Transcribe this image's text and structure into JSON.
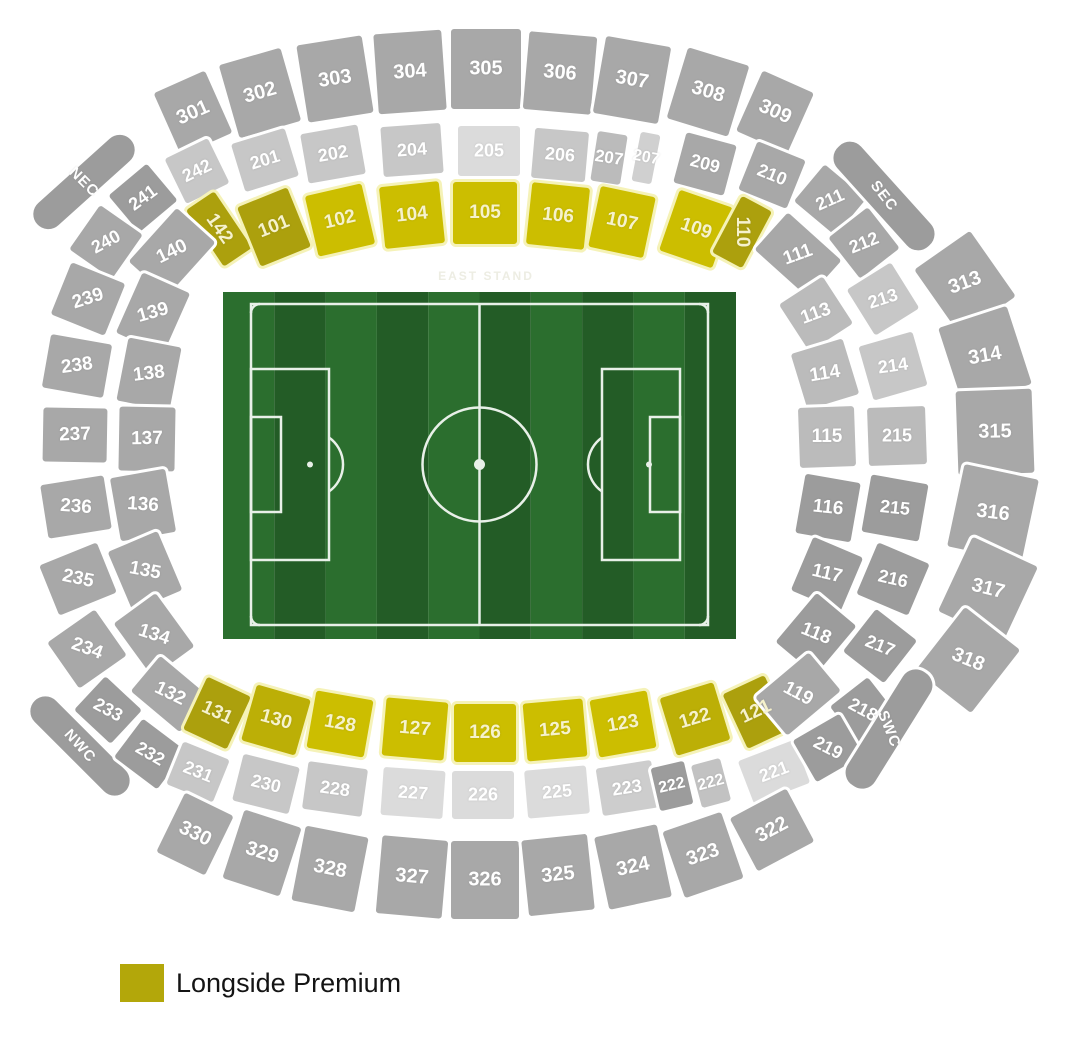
{
  "canvas": {
    "w": 1089,
    "h": 1051,
    "bg": "#FFFFFF"
  },
  "fills": {
    "g": "#A8A8A8",
    "d": "#9C9C9C",
    "l": "#C7C7C7",
    "ll": "#DBDBDB",
    "m": "#BBBBBB",
    "m2": "#D0D0D0",
    "m3": "#CDCDCD",
    "m4": "#C2C2C2",
    "yb": "#CCBE00",
    "ym": "#BCAF06",
    "yd": "#ACA00D"
  },
  "borders": {
    "gray": "#FFFFFF",
    "yellow": "#F5F2B8"
  },
  "text_colors": {
    "gray": "#FFFFFF",
    "yellow": "#F6F2CC"
  },
  "stand_label": {
    "text": "EAST STAND",
    "x": 486,
    "y": 276,
    "color": "#EDEDE3",
    "fs": 12
  },
  "legend": {
    "label": "Longside Premium",
    "swatch": "#B3A70A",
    "x": 120,
    "y": 964
  },
  "pitch": {
    "x": 223,
    "y": 292,
    "w": 513,
    "h": 347,
    "stripe_a": "#2B6E2E",
    "stripe_b": "#235C26",
    "line": "#E8F0E8"
  },
  "sections": [
    {
      "id": "301",
      "label": "301",
      "x": 193,
      "y": 113,
      "w": 62,
      "h": 74,
      "r": -24,
      "f": "g",
      "fs": 20
    },
    {
      "id": "302",
      "label": "302",
      "x": 260,
      "y": 93,
      "w": 70,
      "h": 82,
      "r": -16,
      "f": "g",
      "fs": 20
    },
    {
      "id": "303",
      "label": "303",
      "x": 335,
      "y": 79,
      "w": 72,
      "h": 84,
      "r": -9,
      "f": "g",
      "fs": 20
    },
    {
      "id": "304",
      "label": "304",
      "x": 410,
      "y": 72,
      "w": 74,
      "h": 86,
      "r": -4,
      "f": "g",
      "fs": 20
    },
    {
      "id": "305",
      "label": "305",
      "x": 486,
      "y": 69,
      "w": 76,
      "h": 86,
      "r": 0,
      "f": "g",
      "fs": 20
    },
    {
      "id": "306",
      "label": "306",
      "x": 560,
      "y": 73,
      "w": 74,
      "h": 84,
      "r": 5,
      "f": "g",
      "fs": 20
    },
    {
      "id": "307",
      "label": "307",
      "x": 632,
      "y": 80,
      "w": 72,
      "h": 84,
      "r": 10,
      "f": "g",
      "fs": 20
    },
    {
      "id": "308",
      "label": "308",
      "x": 708,
      "y": 92,
      "w": 70,
      "h": 80,
      "r": 17,
      "f": "g",
      "fs": 20
    },
    {
      "id": "309",
      "label": "309",
      "x": 775,
      "y": 112,
      "w": 62,
      "h": 72,
      "r": 24,
      "f": "g",
      "fs": 20
    },
    {
      "id": "242",
      "label": "242",
      "x": 197,
      "y": 171,
      "w": 54,
      "h": 56,
      "r": -26,
      "f": "l",
      "fs": 18
    },
    {
      "id": "201",
      "label": "201",
      "x": 265,
      "y": 160,
      "w": 62,
      "h": 56,
      "r": -17,
      "f": "l",
      "fs": 18
    },
    {
      "id": "202",
      "label": "202",
      "x": 333,
      "y": 154,
      "w": 64,
      "h": 56,
      "r": -10,
      "f": "l",
      "fs": 18
    },
    {
      "id": "204",
      "label": "204",
      "x": 412,
      "y": 150,
      "w": 66,
      "h": 56,
      "r": -4,
      "f": "l",
      "fs": 18
    },
    {
      "id": "205",
      "label": "205",
      "x": 489,
      "y": 151,
      "w": 68,
      "h": 56,
      "r": 0,
      "f": "ll",
      "fs": 18
    },
    {
      "id": "206",
      "label": "206",
      "x": 560,
      "y": 155,
      "w": 60,
      "h": 56,
      "r": 5,
      "f": "l",
      "fs": 18
    },
    {
      "id": "207-a",
      "label": "207",
      "x": 609,
      "y": 158,
      "w": 36,
      "h": 56,
      "r": 9,
      "f": "m",
      "fs": 17
    },
    {
      "id": "207-b",
      "label": "207",
      "x": 646,
      "y": 158,
      "w": 26,
      "h": 56,
      "r": 11,
      "f": "m2",
      "fs": 16
    },
    {
      "id": "209",
      "label": "209",
      "x": 705,
      "y": 164,
      "w": 58,
      "h": 58,
      "r": 15,
      "f": "g",
      "fs": 18
    },
    {
      "id": "210",
      "label": "210",
      "x": 772,
      "y": 175,
      "w": 58,
      "h": 58,
      "r": 22,
      "f": "g",
      "fs": 18
    },
    {
      "id": "142",
      "label": "142",
      "x": 219,
      "y": 229,
      "w": 40,
      "h": 74,
      "r": -34,
      "tr": 55,
      "f": "yd",
      "fs": 19
    },
    {
      "id": "101",
      "label": "101",
      "x": 274,
      "y": 227,
      "w": 60,
      "h": 70,
      "r": -22,
      "f": "yd",
      "fs": 19
    },
    {
      "id": "102",
      "label": "102",
      "x": 340,
      "y": 220,
      "w": 64,
      "h": 68,
      "r": -13,
      "f": "yb",
      "fs": 19
    },
    {
      "id": "104",
      "label": "104",
      "x": 412,
      "y": 215,
      "w": 66,
      "h": 68,
      "r": -6,
      "f": "yb",
      "fs": 19
    },
    {
      "id": "105",
      "label": "105",
      "x": 485,
      "y": 213,
      "w": 70,
      "h": 68,
      "r": 0,
      "f": "yb",
      "fs": 19
    },
    {
      "id": "106",
      "label": "106",
      "x": 558,
      "y": 216,
      "w": 64,
      "h": 68,
      "r": 6,
      "f": "yb",
      "fs": 19
    },
    {
      "id": "107",
      "label": "107",
      "x": 622,
      "y": 222,
      "w": 62,
      "h": 68,
      "r": 12,
      "f": "yb",
      "fs": 19
    },
    {
      "id": "109",
      "label": "109",
      "x": 696,
      "y": 229,
      "w": 62,
      "h": 70,
      "r": 19,
      "f": "yb",
      "fs": 19
    },
    {
      "id": "110",
      "label": "110",
      "x": 742,
      "y": 232,
      "w": 40,
      "h": 70,
      "r": 28,
      "tr": 90,
      "f": "yd",
      "fs": 19
    },
    {
      "id": "nec",
      "label": "NEC",
      "x": 84,
      "y": 182,
      "w": 132,
      "h": 36,
      "r": -42,
      "tr": 45,
      "f": "d",
      "fs": 15,
      "rad": 18,
      "ls": 1
    },
    {
      "id": "241",
      "label": "241",
      "x": 143,
      "y": 198,
      "w": 56,
      "h": 54,
      "r": -40,
      "tr": -36,
      "f": "d",
      "fs": 18
    },
    {
      "id": "240",
      "label": "240",
      "x": 106,
      "y": 242,
      "w": 60,
      "h": 58,
      "r": -55,
      "tr": -28,
      "f": "g",
      "fs": 18
    },
    {
      "id": "140",
      "label": "140",
      "x": 172,
      "y": 252,
      "w": 78,
      "h": 58,
      "r": -48,
      "tr": -26,
      "f": "g",
      "fs": 19
    },
    {
      "id": "239",
      "label": "239",
      "x": 88,
      "y": 299,
      "w": 62,
      "h": 64,
      "r": -68,
      "tr": -18,
      "f": "g",
      "fs": 19
    },
    {
      "id": "238",
      "label": "238",
      "x": 77,
      "y": 366,
      "w": 60,
      "h": 68,
      "r": -80,
      "tr": -8,
      "f": "g",
      "fs": 19
    },
    {
      "id": "237",
      "label": "237",
      "x": 75,
      "y": 435,
      "w": 60,
      "h": 70,
      "r": -89,
      "tr": -2,
      "f": "g",
      "fs": 19
    },
    {
      "id": "236",
      "label": "236",
      "x": 76,
      "y": 507,
      "w": 60,
      "h": 70,
      "r": 81,
      "tr": 4,
      "f": "g",
      "fs": 19
    },
    {
      "id": "235",
      "label": "235",
      "x": 78,
      "y": 579,
      "w": 60,
      "h": 68,
      "r": 68,
      "tr": 12,
      "f": "g",
      "fs": 19
    },
    {
      "id": "234",
      "label": "234",
      "x": 87,
      "y": 649,
      "w": 62,
      "h": 64,
      "r": 55,
      "tr": 20,
      "f": "g",
      "fs": 19
    },
    {
      "id": "233",
      "label": "233",
      "x": 108,
      "y": 710,
      "w": 56,
      "h": 52,
      "r": 43,
      "tr": 28,
      "f": "d",
      "fs": 18
    },
    {
      "id": "139",
      "label": "139",
      "x": 153,
      "y": 313,
      "w": 72,
      "h": 58,
      "r": -66,
      "tr": -16,
      "f": "g",
      "fs": 19
    },
    {
      "id": "138",
      "label": "138",
      "x": 149,
      "y": 374,
      "w": 70,
      "h": 60,
      "r": -79,
      "tr": -7,
      "f": "g",
      "fs": 19
    },
    {
      "id": "137",
      "label": "137",
      "x": 147,
      "y": 439,
      "w": 70,
      "h": 62,
      "r": -89,
      "tr": -1,
      "f": "g",
      "fs": 19
    },
    {
      "id": "136",
      "label": "136",
      "x": 143,
      "y": 505,
      "w": 70,
      "h": 62,
      "r": 80,
      "tr": 4,
      "f": "g",
      "fs": 19
    },
    {
      "id": "135",
      "label": "135",
      "x": 145,
      "y": 571,
      "w": 70,
      "h": 60,
      "r": 67,
      "tr": 11,
      "f": "g",
      "fs": 19
    },
    {
      "id": "134",
      "label": "134",
      "x": 154,
      "y": 635,
      "w": 72,
      "h": 58,
      "r": 54,
      "tr": 18,
      "f": "g",
      "fs": 19
    },
    {
      "id": "132",
      "label": "132",
      "x": 170,
      "y": 694,
      "w": 70,
      "h": 52,
      "r": 40,
      "tr": 26,
      "f": "g",
      "fs": 19
    },
    {
      "id": "nwc",
      "label": "NWC",
      "x": 80,
      "y": 746,
      "w": 134,
      "h": 36,
      "r": 45,
      "tr": 48,
      "f": "d",
      "fs": 15,
      "rad": 18,
      "ls": 1
    },
    {
      "id": "232",
      "label": "232",
      "x": 150,
      "y": 754,
      "w": 60,
      "h": 54,
      "r": 37,
      "tr": 30,
      "f": "d",
      "fs": 18
    },
    {
      "id": "131",
      "label": "131",
      "x": 217,
      "y": 713,
      "w": 54,
      "h": 64,
      "r": 25,
      "f": "yd",
      "fs": 19
    },
    {
      "id": "130",
      "label": "130",
      "x": 276,
      "y": 720,
      "w": 62,
      "h": 64,
      "r": 16,
      "f": "ym",
      "fs": 19
    },
    {
      "id": "128",
      "label": "128",
      "x": 340,
      "y": 724,
      "w": 64,
      "h": 64,
      "r": 10,
      "f": "yb",
      "fs": 19
    },
    {
      "id": "127",
      "label": "127",
      "x": 415,
      "y": 729,
      "w": 68,
      "h": 64,
      "r": 5,
      "f": "yb",
      "fs": 19
    },
    {
      "id": "126",
      "label": "126",
      "x": 485,
      "y": 733,
      "w": 68,
      "h": 64,
      "r": 0,
      "f": "yb",
      "fs": 19
    },
    {
      "id": "125",
      "label": "125",
      "x": 555,
      "y": 730,
      "w": 66,
      "h": 64,
      "r": -5,
      "f": "yb",
      "fs": 19
    },
    {
      "id": "123",
      "label": "123",
      "x": 623,
      "y": 724,
      "w": 64,
      "h": 64,
      "r": -10,
      "f": "yb",
      "fs": 19
    },
    {
      "id": "122",
      "label": "122",
      "x": 695,
      "y": 719,
      "w": 62,
      "h": 66,
      "r": -17,
      "f": "ym",
      "fs": 19
    },
    {
      "id": "121",
      "label": "121",
      "x": 756,
      "y": 712,
      "w": 52,
      "h": 66,
      "r": -25,
      "f": "yd",
      "fs": 19
    },
    {
      "id": "231",
      "label": "231",
      "x": 198,
      "y": 772,
      "w": 56,
      "h": 52,
      "r": 22,
      "f": "l",
      "fs": 18
    },
    {
      "id": "230",
      "label": "230",
      "x": 266,
      "y": 784,
      "w": 64,
      "h": 54,
      "r": 14,
      "f": "l",
      "fs": 18
    },
    {
      "id": "228",
      "label": "228",
      "x": 335,
      "y": 789,
      "w": 66,
      "h": 54,
      "r": 8,
      "f": "l",
      "fs": 18
    },
    {
      "id": "227",
      "label": "227",
      "x": 413,
      "y": 793,
      "w": 68,
      "h": 54,
      "r": 4,
      "f": "ll",
      "fs": 18
    },
    {
      "id": "226",
      "label": "226",
      "x": 483,
      "y": 795,
      "w": 68,
      "h": 54,
      "r": 0,
      "f": "ll",
      "fs": 18
    },
    {
      "id": "225",
      "label": "225",
      "x": 557,
      "y": 792,
      "w": 68,
      "h": 54,
      "r": -5,
      "f": "ll",
      "fs": 18
    },
    {
      "id": "223",
      "label": "223",
      "x": 627,
      "y": 788,
      "w": 62,
      "h": 54,
      "r": -9,
      "f": "m3",
      "fs": 18
    },
    {
      "id": "222-a",
      "label": "222",
      "x": 672,
      "y": 786,
      "w": 40,
      "h": 50,
      "r": -13,
      "f": "d",
      "fs": 16
    },
    {
      "id": "222-b",
      "label": "222",
      "x": 711,
      "y": 783,
      "w": 36,
      "h": 50,
      "r": -15,
      "f": "m4",
      "fs": 16
    },
    {
      "id": "221",
      "label": "221",
      "x": 774,
      "y": 772,
      "w": 66,
      "h": 52,
      "r": -21,
      "f": "ll",
      "fs": 18
    },
    {
      "id": "330",
      "label": "330",
      "x": 195,
      "y": 834,
      "w": 60,
      "h": 72,
      "r": 26,
      "f": "g",
      "fs": 20
    },
    {
      "id": "329",
      "label": "329",
      "x": 262,
      "y": 853,
      "w": 66,
      "h": 78,
      "r": 18,
      "f": "g",
      "fs": 20
    },
    {
      "id": "328",
      "label": "328",
      "x": 330,
      "y": 869,
      "w": 70,
      "h": 82,
      "r": 11,
      "f": "g",
      "fs": 20
    },
    {
      "id": "327",
      "label": "327",
      "x": 412,
      "y": 877,
      "w": 72,
      "h": 84,
      "r": 5,
      "f": "g",
      "fs": 20
    },
    {
      "id": "326",
      "label": "326",
      "x": 485,
      "y": 880,
      "w": 74,
      "h": 84,
      "r": 0,
      "f": "g",
      "fs": 20
    },
    {
      "id": "325",
      "label": "325",
      "x": 558,
      "y": 875,
      "w": 72,
      "h": 82,
      "r": -6,
      "f": "g",
      "fs": 20
    },
    {
      "id": "324",
      "label": "324",
      "x": 633,
      "y": 867,
      "w": 70,
      "h": 80,
      "r": -12,
      "f": "g",
      "fs": 20
    },
    {
      "id": "323",
      "label": "323",
      "x": 703,
      "y": 855,
      "w": 68,
      "h": 76,
      "r": -19,
      "f": "g",
      "fs": 20
    },
    {
      "id": "322",
      "label": "322",
      "x": 772,
      "y": 830,
      "w": 70,
      "h": 66,
      "r": -28,
      "f": "g",
      "fs": 20
    },
    {
      "id": "111",
      "label": "111",
      "x": 798,
      "y": 255,
      "w": 78,
      "h": 56,
      "r": 42,
      "tr": -20,
      "f": "g",
      "fs": 19
    },
    {
      "id": "113",
      "label": "113",
      "x": 816,
      "y": 314,
      "w": 62,
      "h": 58,
      "r": 57,
      "tr": -20,
      "f": "m",
      "fs": 19
    },
    {
      "id": "114",
      "label": "114",
      "x": 825,
      "y": 374,
      "w": 64,
      "h": 60,
      "r": 73,
      "tr": -9,
      "f": "m",
      "fs": 19
    },
    {
      "id": "115",
      "label": "115",
      "x": 827,
      "y": 437,
      "w": 66,
      "h": 62,
      "r": 88,
      "tr": 0,
      "f": "m",
      "fs": 19
    },
    {
      "id": "116",
      "label": "116",
      "x": 828,
      "y": 508,
      "w": 66,
      "h": 62,
      "r": 100,
      "tr": 6,
      "f": "d",
      "fs": 19
    },
    {
      "id": "117",
      "label": "117",
      "x": 827,
      "y": 574,
      "w": 64,
      "h": 60,
      "r": 113,
      "tr": 13,
      "f": "d",
      "fs": 19
    },
    {
      "id": "118",
      "label": "118",
      "x": 816,
      "y": 634,
      "w": 70,
      "h": 58,
      "r": 130,
      "tr": 22,
      "f": "d",
      "fs": 19
    },
    {
      "id": "119",
      "label": "119",
      "x": 798,
      "y": 694,
      "w": 76,
      "h": 56,
      "r": 140,
      "tr": 28,
      "f": "g",
      "fs": 19
    },
    {
      "id": "211",
      "label": "211",
      "x": 830,
      "y": 200,
      "w": 60,
      "h": 54,
      "r": 40,
      "tr": -24,
      "f": "g",
      "fs": 18
    },
    {
      "id": "212",
      "label": "212",
      "x": 864,
      "y": 243,
      "w": 58,
      "h": 56,
      "r": 52,
      "tr": -22,
      "f": "g",
      "fs": 18
    },
    {
      "id": "213",
      "label": "213",
      "x": 883,
      "y": 299,
      "w": 60,
      "h": 58,
      "r": 58,
      "tr": -18,
      "f": "l",
      "fs": 18
    },
    {
      "id": "214",
      "label": "214",
      "x": 893,
      "y": 366,
      "w": 62,
      "h": 62,
      "r": 74,
      "tr": -8,
      "f": "l",
      "fs": 18
    },
    {
      "id": "215-a",
      "label": "215",
      "x": 897,
      "y": 436,
      "w": 64,
      "h": 64,
      "r": 88,
      "tr": 0,
      "f": "m",
      "fs": 18
    },
    {
      "id": "215-b",
      "label": "215",
      "x": 895,
      "y": 508,
      "w": 64,
      "h": 64,
      "r": 100,
      "tr": 6,
      "f": "d",
      "fs": 18
    },
    {
      "id": "216",
      "label": "216",
      "x": 893,
      "y": 579,
      "w": 62,
      "h": 62,
      "r": 113,
      "tr": 13,
      "f": "d",
      "fs": 18
    },
    {
      "id": "217",
      "label": "217",
      "x": 880,
      "y": 646,
      "w": 60,
      "h": 58,
      "r": 128,
      "tr": 22,
      "f": "d",
      "fs": 18
    },
    {
      "id": "218",
      "label": "218",
      "x": 863,
      "y": 710,
      "w": 54,
      "h": 52,
      "r": 142,
      "tr": 28,
      "f": "d",
      "fs": 18
    },
    {
      "id": "219",
      "label": "219",
      "x": 828,
      "y": 748,
      "w": 60,
      "h": 54,
      "r": 150,
      "tr": 27,
      "f": "d",
      "fs": 18
    },
    {
      "id": "313",
      "label": "313",
      "x": 965,
      "y": 283,
      "w": 86,
      "h": 74,
      "r": 55,
      "tr": -20,
      "f": "g",
      "fs": 20
    },
    {
      "id": "314",
      "label": "314",
      "x": 985,
      "y": 356,
      "w": 88,
      "h": 78,
      "r": 72,
      "tr": -10,
      "f": "g",
      "fs": 20
    },
    {
      "id": "315",
      "label": "315",
      "x": 995,
      "y": 432,
      "w": 90,
      "h": 82,
      "r": 88,
      "tr": -1,
      "f": "g",
      "fs": 20
    },
    {
      "id": "316",
      "label": "316",
      "x": 993,
      "y": 513,
      "w": 90,
      "h": 82,
      "r": 102,
      "tr": 7,
      "f": "g",
      "fs": 20
    },
    {
      "id": "317",
      "label": "317",
      "x": 988,
      "y": 589,
      "w": 88,
      "h": 78,
      "r": 115,
      "tr": 14,
      "f": "g",
      "fs": 20
    },
    {
      "id": "318",
      "label": "318",
      "x": 968,
      "y": 660,
      "w": 86,
      "h": 76,
      "r": 128,
      "tr": 22,
      "f": "g",
      "fs": 20
    },
    {
      "id": "sec",
      "label": "SEC",
      "x": 884,
      "y": 196,
      "w": 140,
      "h": 38,
      "r": 48,
      "tr": 52,
      "f": "d",
      "fs": 15,
      "rad": 18,
      "ls": 1
    },
    {
      "id": "swc",
      "label": "SWC",
      "x": 889,
      "y": 729,
      "w": 140,
      "h": 38,
      "r": 122,
      "tr": 68,
      "f": "d",
      "fs": 15,
      "rad": 18,
      "ls": 1
    }
  ]
}
